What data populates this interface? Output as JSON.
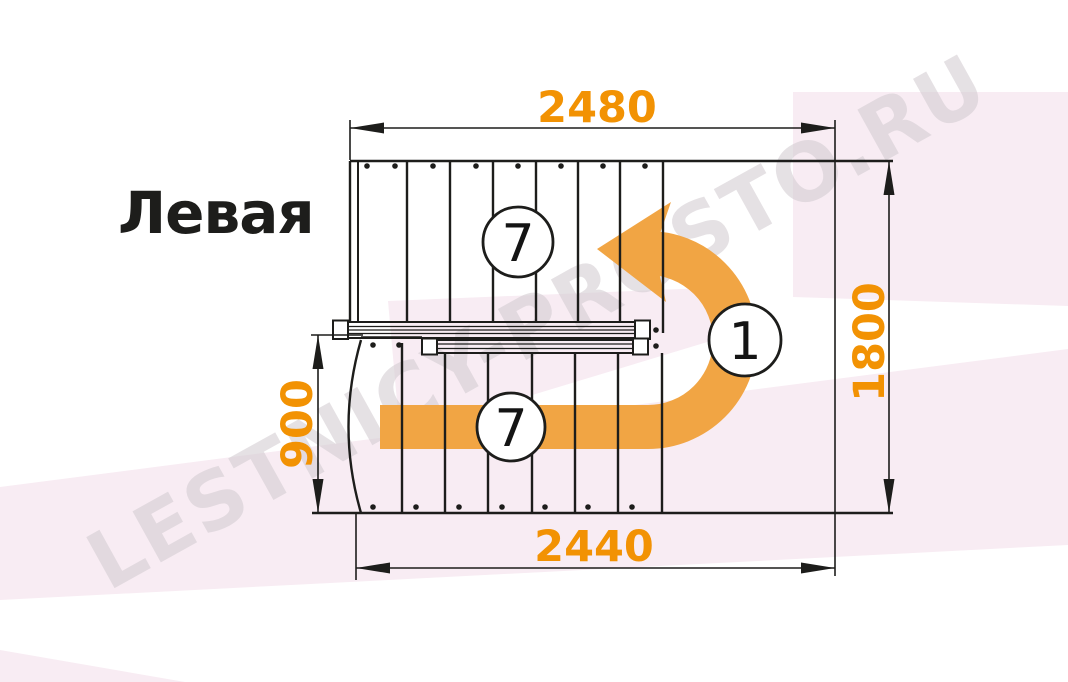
{
  "title": "Левая",
  "watermark": {
    "text": "LESTNICY-PROSTO.RU"
  },
  "diagram": {
    "type": "staircase-floor-plan",
    "dimensions": {
      "top_width": "2480",
      "bottom_width": "2440",
      "right_depth": "1800",
      "left_flight_width": "900"
    },
    "markers": {
      "upper_flight_steps": "7",
      "lower_flight_steps": "7",
      "turn_number": "1"
    }
  },
  "colors": {
    "dimension_orange": "#f29203",
    "arrow_orange": "#f1a544",
    "line_black": "#1d1d1b",
    "pink_tint": "#f8ecf3",
    "watermark_gray": "#d5ced3"
  }
}
